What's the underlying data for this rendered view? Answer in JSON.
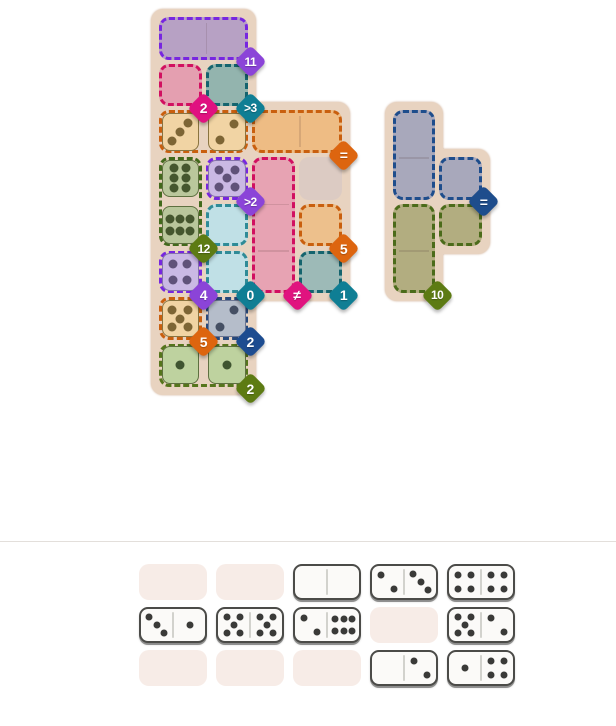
{
  "colors": {
    "page_bg": "#ffffff",
    "separator": "#e3dfdb",
    "board_bg": "#e8d3c0",
    "empty_slot": "#f7ece7",
    "domino_fill": "#fbfaf8",
    "domino_border": "#4b4b48",
    "domino_divider": "#d2d2cd",
    "domino_pip": "#3a3a38",
    "cell_divider": "rgba(70,40,40,0.14)"
  },
  "grid": {
    "origin_x": 157,
    "origin_y": 15,
    "cell_size": 46.7
  },
  "separator_y": 541,
  "boards": [
    {
      "name": "left-board",
      "rects": [
        {
          "col": 1,
          "row": 1,
          "w": 2,
          "h": 8
        },
        {
          "col": 1,
          "row": 3,
          "w": 4,
          "h": 4
        }
      ]
    },
    {
      "name": "right-board",
      "rects": [
        {
          "col": 6,
          "row": 3,
          "w": 1,
          "h": 4
        },
        {
          "col": 6,
          "row": 4,
          "w": 2,
          "h": 2
        }
      ]
    }
  ],
  "regions": [
    {
      "name": "region-purple-11",
      "col": 1,
      "row": 1,
      "w": 2,
      "h": 1,
      "fill": "#b7a1c4",
      "border": "#7726e0",
      "dividers": true
    },
    {
      "name": "region-pink-2",
      "col": 1,
      "row": 2,
      "w": 1,
      "h": 1,
      "fill": "#e49fb0",
      "border": "#d11060",
      "dividers": false
    },
    {
      "name": "region-teal-gt3",
      "col": 2,
      "row": 2,
      "w": 1,
      "h": 1,
      "fill": "#93b4ae",
      "border": "#15646e",
      "dividers": false
    },
    {
      "name": "region-orange-domino",
      "col": 1,
      "row": 3,
      "w": 2,
      "h": 1,
      "fill": "none",
      "border": "#c95f0e",
      "dividers": false
    },
    {
      "name": "region-orange-eq",
      "col": 3,
      "row": 3,
      "w": 2,
      "h": 1,
      "fill": "#eebc84",
      "border": "#c95f0e",
      "dividers": true
    },
    {
      "name": "region-green-12",
      "col": 1,
      "row": 4,
      "w": 1,
      "h": 2,
      "fill": "none",
      "border": "#42691c",
      "dividers": false
    },
    {
      "name": "region-purple-gt2",
      "col": 2,
      "row": 4,
      "w": 1,
      "h": 1,
      "fill": "none",
      "border": "#7726e0",
      "dividers": false
    },
    {
      "name": "region-pink-neq",
      "col": 3,
      "row": 4,
      "w": 1,
      "h": 3,
      "fill": "#e7a3b3",
      "border": "#d11060",
      "dividers": true
    },
    {
      "name": "cell-neutral-grey",
      "col": 4,
      "row": 4,
      "w": 1,
      "h": 1,
      "fill": "#dccbc3",
      "border": null,
      "dividers": false
    },
    {
      "name": "region-cyan-0-upper",
      "col": 2,
      "row": 5,
      "w": 1,
      "h": 1,
      "fill": "#c0e0e6",
      "border": "#2f8b97",
      "dividers": false
    },
    {
      "name": "region-cyan-0-lower",
      "col": 2,
      "row": 6,
      "w": 1,
      "h": 1,
      "fill": "#c0e0e6",
      "border": "#2f8b97",
      "dividers": false
    },
    {
      "name": "region-orange-5",
      "col": 4,
      "row": 5,
      "w": 1,
      "h": 1,
      "fill": "#edc08c",
      "border": "#c95f0e",
      "dividers": false
    },
    {
      "name": "region-purple-4",
      "col": 1,
      "row": 6,
      "w": 1,
      "h": 1,
      "fill": "none",
      "border": "#7726e0",
      "dividers": false
    },
    {
      "name": "region-teal-1",
      "col": 4,
      "row": 6,
      "w": 1,
      "h": 1,
      "fill": "#9dbab7",
      "border": "#15646e",
      "dividers": false
    },
    {
      "name": "region-tan-5",
      "col": 1,
      "row": 7,
      "w": 1,
      "h": 1,
      "fill": "none",
      "border": "#c95f0e",
      "dividers": false
    },
    {
      "name": "region-navy-2",
      "col": 2,
      "row": 7,
      "w": 1,
      "h": 1,
      "fill": "none",
      "border": "#27497c",
      "dividers": false
    },
    {
      "name": "region-green-2",
      "col": 1,
      "row": 8,
      "w": 2,
      "h": 1,
      "fill": "none",
      "border": "#55751c",
      "dividers": false
    },
    {
      "name": "region-navy-eq-main",
      "col": 6,
      "row": 3,
      "w": 1,
      "h": 2,
      "fill": "#a8a8bb",
      "border": "#1e4d8c",
      "dividers": true
    },
    {
      "name": "region-navy-eq-arm",
      "col": 7,
      "row": 4,
      "w": 1,
      "h": 1,
      "fill": "#a8a8bb",
      "border": "#1e4d8c",
      "dividers": false
    },
    {
      "name": "region-olive-10-main",
      "col": 6,
      "row": 5,
      "w": 1,
      "h": 2,
      "fill": "#b2ad80",
      "border": "#4b6b1a",
      "dividers": true
    },
    {
      "name": "region-olive-10-arm",
      "col": 7,
      "row": 5,
      "w": 1,
      "h": 1,
      "fill": "#b2ad80",
      "border": "#4b6b1a",
      "dividers": false
    }
  ],
  "pip_layouts": {
    "p1": [
      [
        50,
        50
      ]
    ],
    "d2r": [
      [
        70,
        27
      ],
      [
        30,
        73
      ]
    ],
    "d3r": [
      [
        72,
        25
      ],
      [
        50,
        50
      ],
      [
        28,
        75
      ]
    ],
    "p4": [
      [
        30,
        28
      ],
      [
        70,
        28
      ],
      [
        30,
        72
      ],
      [
        70,
        72
      ]
    ],
    "p5": [
      [
        28,
        26
      ],
      [
        72,
        26
      ],
      [
        50,
        50
      ],
      [
        28,
        74
      ],
      [
        72,
        74
      ]
    ],
    "v6": [
      [
        33,
        22
      ],
      [
        67,
        22
      ],
      [
        33,
        50
      ],
      [
        67,
        50
      ],
      [
        33,
        78
      ],
      [
        67,
        78
      ]
    ],
    "h6": [
      [
        22,
        33
      ],
      [
        50,
        33
      ],
      [
        78,
        33
      ],
      [
        22,
        67
      ],
      [
        50,
        67
      ],
      [
        78,
        67
      ]
    ]
  },
  "placed_halves": [
    {
      "col": 1,
      "row": 3,
      "value": 3,
      "layout": "d3r",
      "fill": "#f1d4a4",
      "pip": "#7d6535",
      "edge": "#8a7440"
    },
    {
      "col": 2,
      "row": 3,
      "value": 2,
      "layout": "d2r",
      "fill": "#f1d4a4",
      "pip": "#7d6535",
      "edge": "#8a7440"
    },
    {
      "col": 1,
      "row": 4,
      "value": 6,
      "layout": "v6",
      "fill": "#bac79c",
      "pip": "#45562e",
      "edge": "#5e7040"
    },
    {
      "col": 2,
      "row": 4,
      "value": 5,
      "layout": "p5",
      "fill": "#cab9e4",
      "pip": "#605279",
      "edge": "#8472ab"
    },
    {
      "col": 1,
      "row": 5,
      "value": 6,
      "layout": "h6",
      "fill": "#b9c69b",
      "pip": "#45562e",
      "edge": "#5e7040"
    },
    {
      "col": 1,
      "row": 6,
      "value": 4,
      "layout": "p4",
      "fill": "#cab9e4",
      "pip": "#605279",
      "edge": "#8472ab"
    },
    {
      "col": 1,
      "row": 7,
      "value": 5,
      "layout": "p5",
      "fill": "#f1d4a4",
      "pip": "#7d6535",
      "edge": "#8a7440"
    },
    {
      "col": 2,
      "row": 7,
      "value": 2,
      "layout": "d2r",
      "fill": "#b5bdca",
      "pip": "#454f63",
      "edge": "#6b7693"
    },
    {
      "col": 1,
      "row": 8,
      "value": 1,
      "layout": "p1",
      "fill": "#bed29f",
      "pip": "#3f5430",
      "edge": "#5e7040"
    },
    {
      "col": 2,
      "row": 8,
      "value": 1,
      "layout": "p1",
      "fill": "#bed29f",
      "pip": "#3f5430",
      "edge": "#5e7040"
    }
  ],
  "badges": [
    {
      "label": "11",
      "col": 2,
      "row": 1,
      "color": "#8b44d8"
    },
    {
      "label": "2",
      "col": 1,
      "row": 2,
      "color": "#e01180"
    },
    {
      "label": ">3",
      "col": 2,
      "row": 2,
      "color": "#0f7e94"
    },
    {
      "label": "=",
      "col": 4,
      "row": 3,
      "color": "#dd650f"
    },
    {
      "label": ">2",
      "col": 2,
      "row": 4,
      "color": "#8b44d8"
    },
    {
      "label": "12",
      "col": 1,
      "row": 5,
      "color": "#5d7b13"
    },
    {
      "label": "5",
      "col": 4,
      "row": 5,
      "color": "#dd650f"
    },
    {
      "label": "4",
      "col": 1,
      "row": 6,
      "color": "#8b44d8"
    },
    {
      "label": "0",
      "col": 2,
      "row": 6,
      "color": "#0f7e94"
    },
    {
      "label": "≠",
      "col": 3,
      "row": 6,
      "color": "#e0137f"
    },
    {
      "label": "1",
      "col": 4,
      "row": 6,
      "color": "#0f7e94"
    },
    {
      "label": "5",
      "col": 1,
      "row": 7,
      "color": "#dd650f"
    },
    {
      "label": "2",
      "col": 2,
      "row": 7,
      "color": "#1d4c90"
    },
    {
      "label": "2",
      "col": 2,
      "row": 8,
      "color": "#5d7b13"
    },
    {
      "label": "=",
      "col": 7,
      "row": 4,
      "color": "#1e4d8c"
    },
    {
      "label": "10",
      "col": 6,
      "row": 6,
      "color": "#5d7b13"
    }
  ],
  "tray_pip_layouts": {
    "0": [],
    "1": [
      [
        50,
        50
      ]
    ],
    "2": [
      [
        30,
        28
      ],
      [
        70,
        72
      ]
    ],
    "3": [
      [
        26,
        25
      ],
      [
        50,
        50
      ],
      [
        74,
        75
      ]
    ],
    "4": [
      [
        30,
        28
      ],
      [
        70,
        28
      ],
      [
        30,
        72
      ],
      [
        70,
        72
      ]
    ],
    "5": [
      [
        28,
        26
      ],
      [
        72,
        26
      ],
      [
        50,
        50
      ],
      [
        28,
        74
      ],
      [
        72,
        74
      ]
    ],
    "6": [
      [
        24,
        32
      ],
      [
        50,
        32
      ],
      [
        76,
        32
      ],
      [
        24,
        68
      ],
      [
        50,
        68
      ],
      [
        76,
        68
      ]
    ]
  },
  "tray": {
    "origin_x": 139,
    "origin_y": 564,
    "pitch_x": 77,
    "pitch_y": 43,
    "slots": [
      [
        null,
        null,
        [
          0,
          0
        ],
        [
          2,
          3
        ],
        [
          4,
          4
        ]
      ],
      [
        [
          3,
          1
        ],
        [
          5,
          5
        ],
        [
          2,
          6
        ],
        null,
        [
          5,
          2
        ]
      ],
      [
        null,
        null,
        null,
        [
          0,
          2
        ],
        [
          1,
          4
        ]
      ]
    ]
  }
}
